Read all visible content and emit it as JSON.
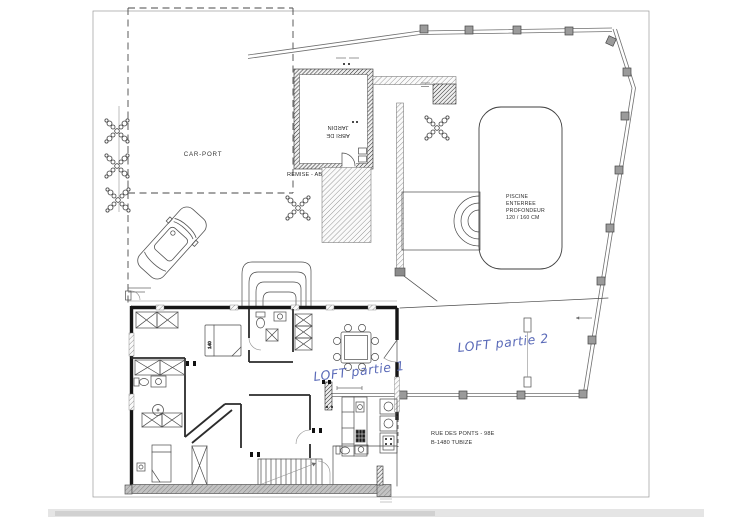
{
  "plan": {
    "carport_label": "CAR-PORT",
    "remise_label": "REMISE - ABRI",
    "shed_label_line1": "ABRI DE",
    "shed_label_line2": "JARDIN",
    "pool_lines": [
      "PISCINE",
      "ENTERREE",
      "PROFONDEUR",
      "120 / 160 CM"
    ],
    "loft1_label": "LOFT partie 1",
    "loft2_label": "LOFT partie 2",
    "address_line1": "RUE DES PONTS - 98E",
    "address_line2": "B-1480 TUBIZE",
    "bed_dimension": "140"
  },
  "colors": {
    "ink": "#3f3f3f",
    "wall_black": "#161616",
    "handwriting_blue": "#5a6ab8",
    "post_gray": "#9b9b9b",
    "wall_gray": "#c2c2c2",
    "paper": "#ffffff"
  }
}
